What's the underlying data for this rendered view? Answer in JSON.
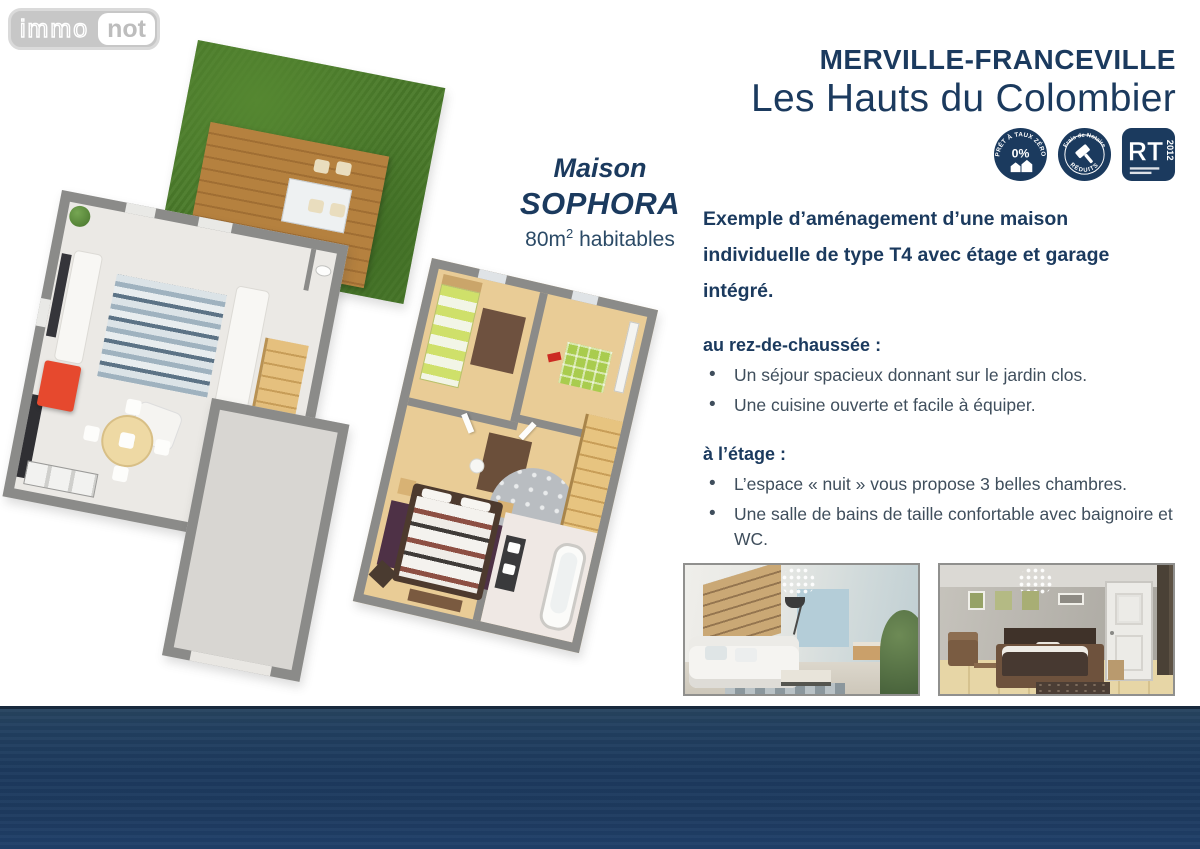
{
  "logo": {
    "part1": "immo",
    "part2": "not"
  },
  "header": {
    "location": "MERVILLE-FRANCEVILLE",
    "residence": "Les Hauts du Colombier"
  },
  "badges": {
    "ptz": {
      "icon": "house-icon",
      "arc_text": "PRÊT À TAUX ZÉRO",
      "center_text": "0%"
    },
    "notaire": {
      "icon": "gavel-icon",
      "arc_top": "Frais de Notaire",
      "arc_bottom": "RÉDUITS"
    },
    "rt": {
      "label": "RT",
      "year": "2012"
    }
  },
  "plan": {
    "house_label_line1": "Maison",
    "house_label_line2": "SOPHORA",
    "area_value": "80m",
    "area_sup": "2",
    "area_suffix": " habitables"
  },
  "description": {
    "intro": "Exemple d’aménagement d’une maison individuelle de type T4 avec étage et garage intégré.",
    "ground_floor": {
      "title": "au rez-de-chaussée :",
      "bullets": [
        "Un séjour spacieux donnant sur le jardin clos.",
        "Une cuisine ouverte et facile à équiper."
      ]
    },
    "upper_floor": {
      "title": "à l’étage :",
      "bullets": [
        "L’espace « nuit » vous propose 3 belles chambres.",
        "Une salle de bains de taille confortable avec baignoire et WC."
      ]
    }
  },
  "colors": {
    "navy": "#1b3a5e",
    "body_text": "#3f4e5c",
    "footer": "#1e3b60",
    "garden_green": "#4a7a2a",
    "deck_wood": "#b5813f",
    "wall_gray": "#8b8b89",
    "upper_floor_wood": "#e9cc96",
    "accent_red": "#e6492e"
  }
}
